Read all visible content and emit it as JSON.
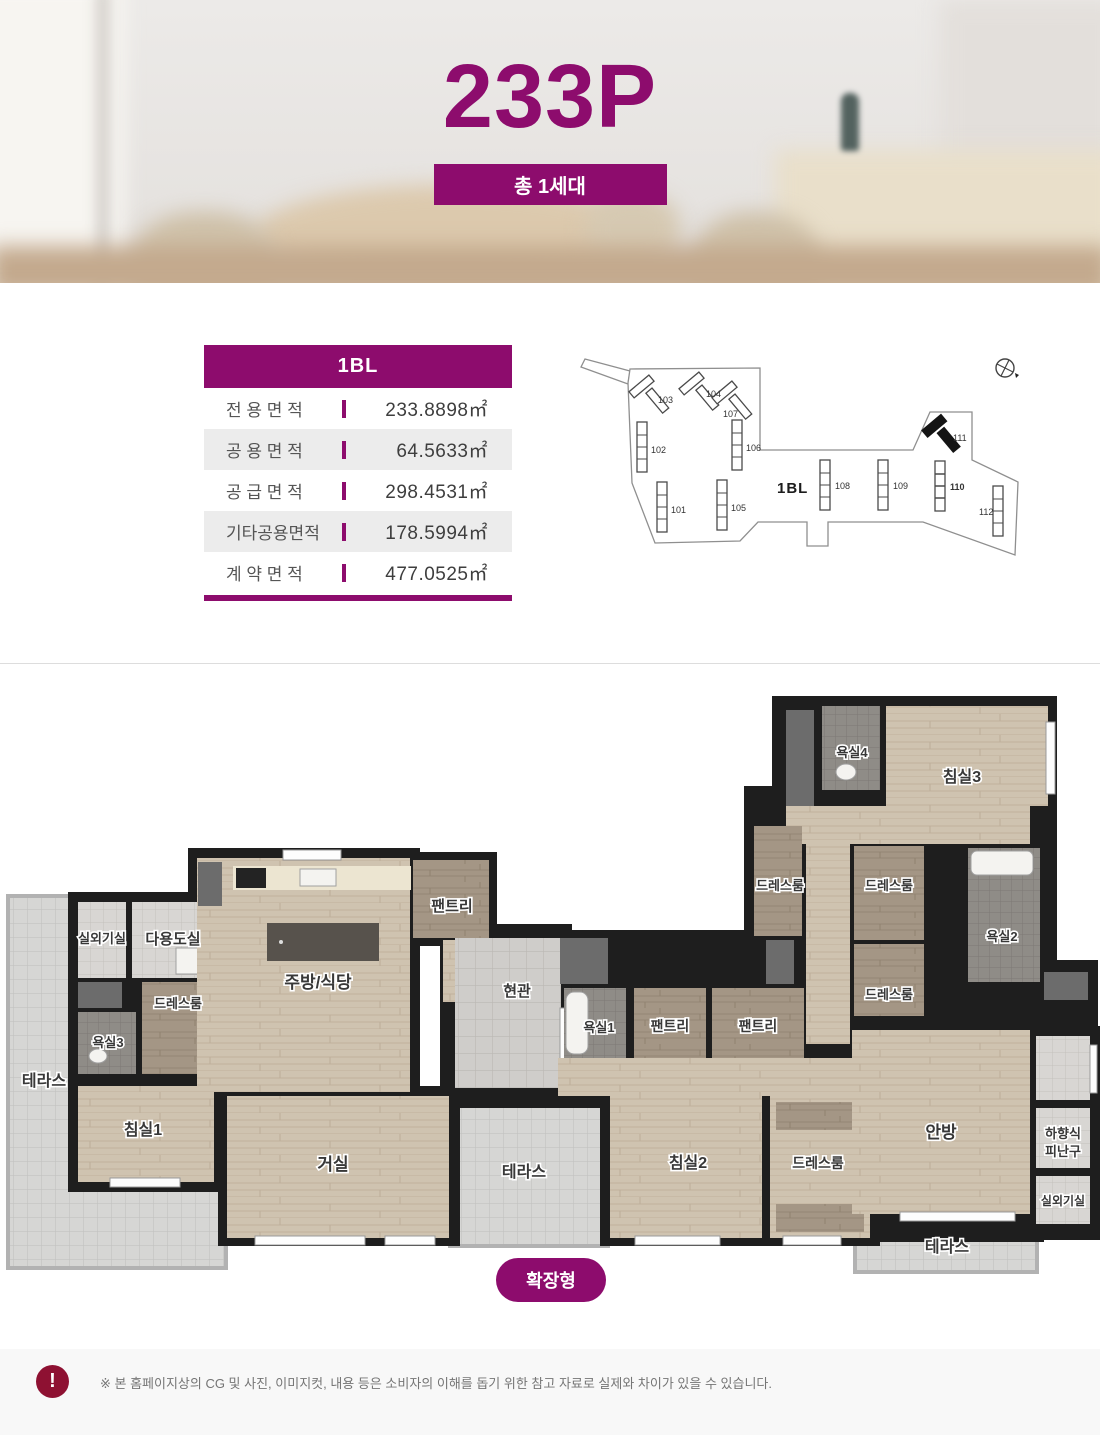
{
  "colors": {
    "accent": "#8d0c6d",
    "alert": "#8e1132",
    "wall": "#1e1e1e"
  },
  "hero": {
    "title": "233P",
    "badge": "총 1세대"
  },
  "area_table": {
    "header": "1BL",
    "rows": [
      {
        "label": "전 용 면 적",
        "value": "233.8898㎡"
      },
      {
        "label": "공 용 면 적",
        "value": "64.5633㎡"
      },
      {
        "label": "공 급 면 적",
        "value": "298.4531㎡"
      },
      {
        "label": "기타공용면적",
        "value": "178.5994㎡"
      },
      {
        "label": "계 약 면 적",
        "value": "477.0525㎡"
      }
    ]
  },
  "site_plan": {
    "block_label": "1BL",
    "buildings": [
      "101",
      "102",
      "103",
      "104",
      "105",
      "106",
      "107",
      "108",
      "109",
      "110",
      "111",
      "112"
    ],
    "highlighted": "111"
  },
  "floor_plan": {
    "type_badge": "확장형",
    "rooms": [
      "실외기실",
      "다용도실",
      "팬트리",
      "주방/식당",
      "현관",
      "드레스룸",
      "욕실3",
      "테라스",
      "침실1",
      "거실",
      "테라스",
      "욕실1",
      "팬트리",
      "팬트리",
      "욕실4",
      "침실3",
      "드레스룸",
      "드레스룸",
      "욕실2",
      "드레스룸",
      "침실2",
      "드레스룸",
      "안방",
      "하향식",
      "피난구",
      "실외기실",
      "테라스"
    ]
  },
  "footer": {
    "disclaimer": "※ 본 홈페이지상의 CG 및 사진, 이미지컷, 내용 등은 소비자의 이해를 돕기 위한 참고 자료로 실제와 차이가 있을 수 있습니다."
  }
}
